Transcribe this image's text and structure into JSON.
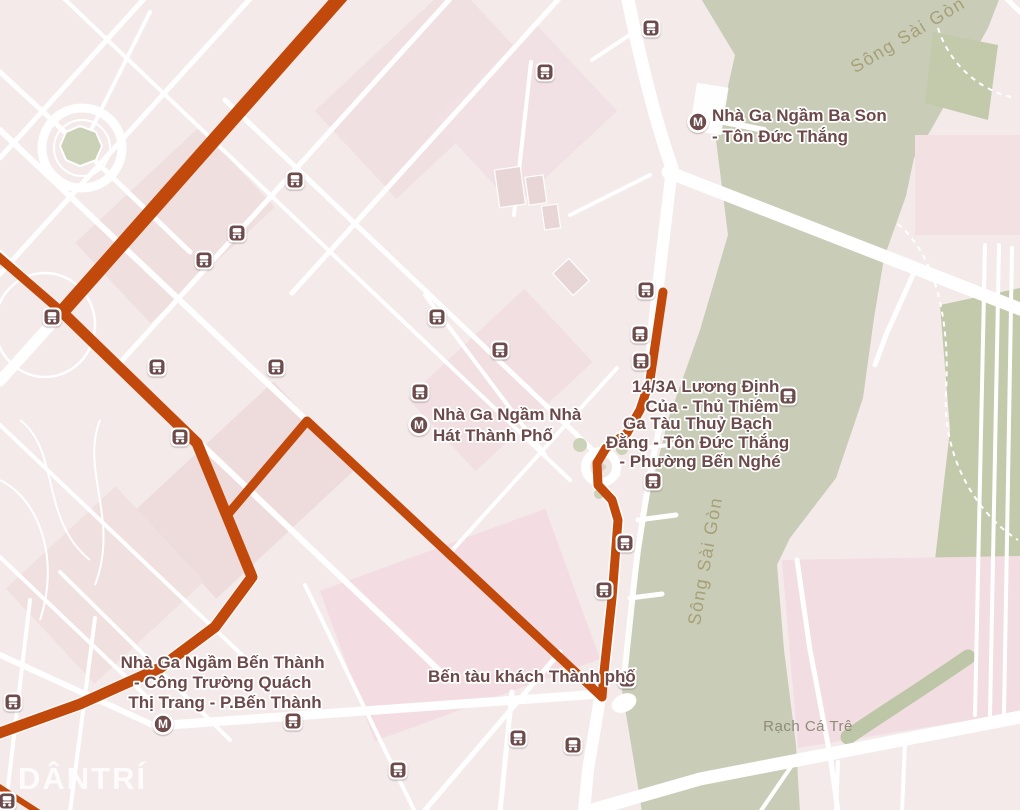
{
  "map": {
    "watermark": "DÂNTRÍ",
    "metro_letter": "M",
    "colors": {
      "route": "#c1490b",
      "river": "#c9ccb6",
      "park": "#c2caab",
      "marker": "#6d4c4c",
      "label": "#6d4949",
      "water_label": "#a7a078"
    },
    "stations": {
      "ba_son": {
        "lines": [
          "Nhà Ga Ngầm Ba Son",
          "- Tôn Đức Thắng"
        ]
      },
      "nha_hat": {
        "lines": [
          "Nhà Ga Ngầm Nhà",
          "Hát Thành Phố"
        ]
      },
      "luong_dinh_cua": {
        "lines": [
          "14/3A Lương Định",
          "Của - Thủ Thiêm"
        ]
      },
      "ga_tau_thuy": {
        "lines": [
          "Ga Tàu Thuỷ Bạch",
          "Đằng - Tôn Đức Thắng",
          "- Phường Bến Nghé"
        ]
      },
      "ben_thanh": {
        "lines": [
          "Nhà Ga Ngầm Bến Thành",
          "- Công Trường Quách",
          "Thị Trang - P.Bến Thành"
        ]
      },
      "ben_tau": {
        "lines": [
          "Bến tàu khách Thành phố"
        ]
      }
    },
    "water_labels": {
      "song_sai_gon_top": "Sông Sài Gòn",
      "song_sai_gon_mid": "Sông Sài Gòn",
      "rach_ca_tre": "Rạch Cá Trê"
    },
    "routes": [
      {
        "name": "main-nw-diagonal",
        "width": 14,
        "points": [
          [
            345,
            -8
          ],
          [
            62,
            312
          ]
        ]
      },
      {
        "name": "west-spur",
        "width": 9,
        "points": [
          [
            -6,
            253
          ],
          [
            62,
            312
          ]
        ]
      },
      {
        "name": "main-south",
        "width": 11,
        "points": [
          [
            62,
            312
          ],
          [
            197,
            443
          ],
          [
            252,
            577
          ],
          [
            215,
            627
          ],
          [
            160,
            668
          ],
          [
            80,
            704
          ],
          [
            -6,
            735
          ]
        ]
      },
      {
        "name": "dong-khoi-branch",
        "width": 9,
        "points": [
          [
            229,
            513
          ],
          [
            307,
            421
          ],
          [
            602,
            697
          ]
        ]
      },
      {
        "name": "ton-duc-thang",
        "width": 9,
        "points": [
          [
            663,
            292
          ],
          [
            650,
            380
          ],
          [
            640,
            410
          ],
          [
            627,
            433
          ],
          [
            606,
            448
          ],
          [
            597,
            463
          ],
          [
            598,
            485
          ],
          [
            612,
            500
          ],
          [
            618,
            520
          ],
          [
            612,
            598
          ],
          [
            604,
            672
          ],
          [
            602,
            697
          ]
        ]
      },
      {
        "name": "sw-corner",
        "width": 6,
        "points": [
          [
            -4,
            785
          ],
          [
            38,
            812
          ]
        ]
      }
    ],
    "bus_stops": [
      [
        651,
        28
      ],
      [
        545,
        72
      ],
      [
        295,
        180
      ],
      [
        237,
        233
      ],
      [
        204,
        260
      ],
      [
        646,
        290
      ],
      [
        52,
        317
      ],
      [
        437,
        317
      ],
      [
        640,
        334
      ],
      [
        500,
        350
      ],
      [
        641,
        361
      ],
      [
        276,
        367
      ],
      [
        157,
        367
      ],
      [
        420,
        392
      ],
      [
        788,
        396
      ],
      [
        180,
        437
      ],
      [
        653,
        481
      ],
      [
        625,
        543
      ],
      [
        604,
        590
      ],
      [
        627,
        679
      ],
      [
        13,
        702
      ],
      [
        293,
        721
      ],
      [
        518,
        738
      ],
      [
        573,
        745
      ],
      [
        398,
        770
      ],
      [
        7,
        801
      ]
    ],
    "metro_stations": [
      [
        698,
        122
      ],
      [
        419,
        425
      ],
      [
        163,
        724
      ]
    ]
  }
}
